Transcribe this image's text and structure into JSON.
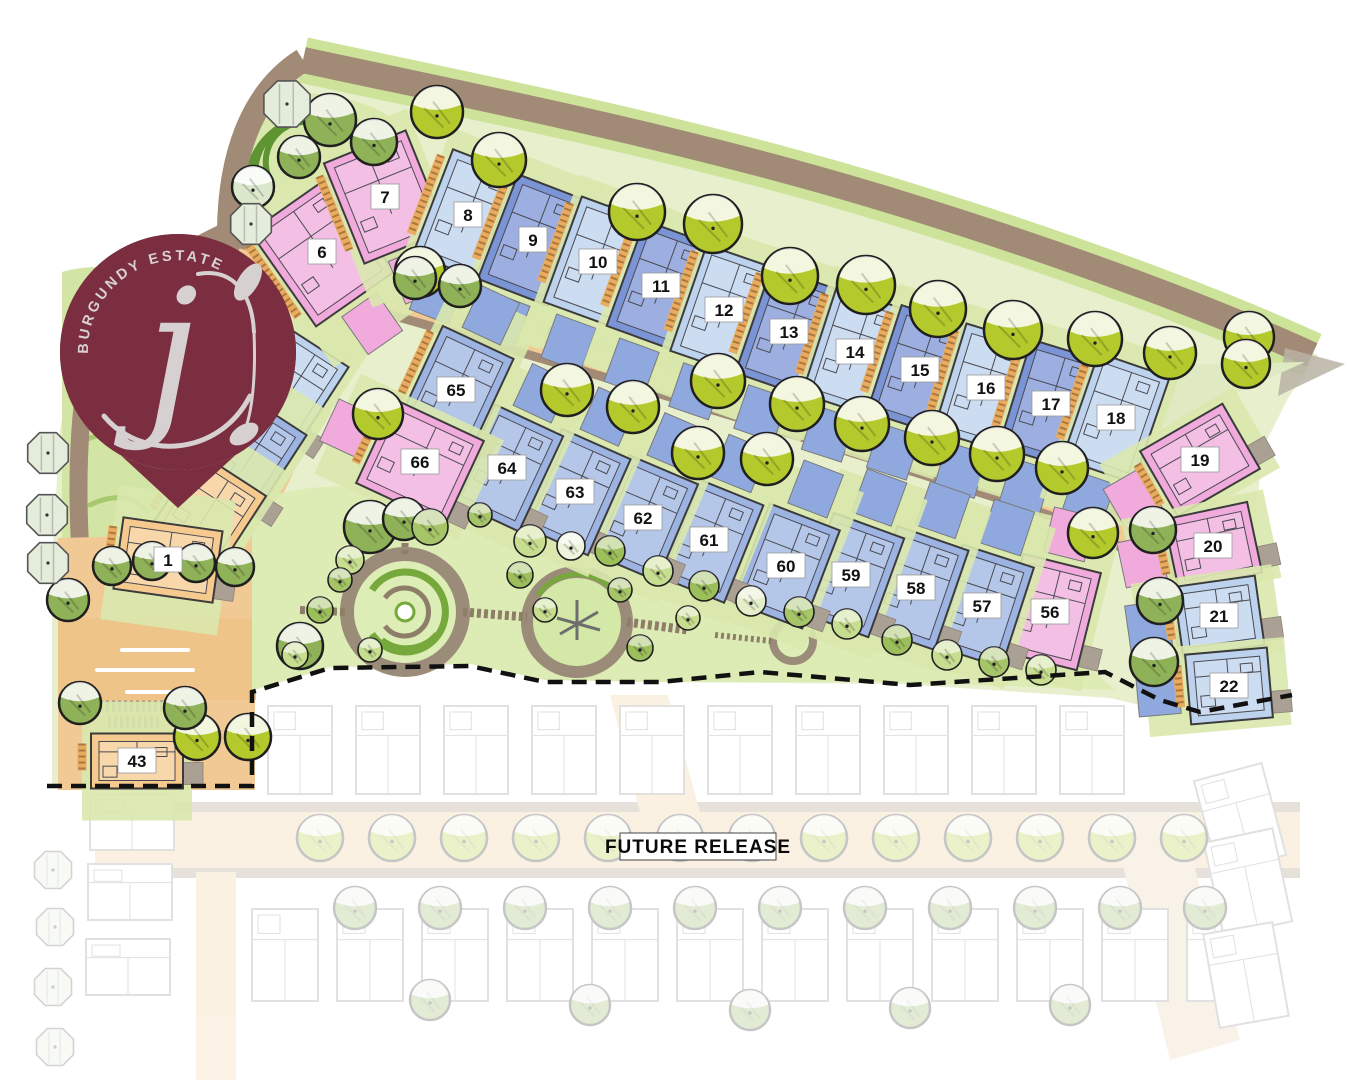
{
  "logo": {
    "estate_name": "BURGUNDY ESTATE",
    "monogram": "j",
    "pin_color": "#7a2e40",
    "text_color": "#d9d2d3"
  },
  "future_release": {
    "label": "FUTURE RELEASE"
  },
  "palette": {
    "dark_blue": "#7b94d6",
    "medium_blue": "#9db4e2",
    "light_blue": "#bdd2ec",
    "pink": "#f0aadb",
    "tan": "#f6ca8e",
    "accent_blue": "#8fa8dd",
    "grass": "#e8efcd",
    "park": "#ddecb4",
    "road_brown": "#a18b76",
    "road_tan": "#f0c994",
    "tree_lime": "#b3c92c",
    "tree_green": "#8fb158"
  },
  "lots": [
    {
      "num": "1",
      "x": 168,
      "y": 560,
      "rot": 8,
      "w": 100,
      "h": 72,
      "color": "tan",
      "acc": ""
    },
    {
      "num": "6",
      "x": 322,
      "y": 252,
      "rot": -35,
      "w": 95,
      "h": 115,
      "color": "pink",
      "acc": "S"
    },
    {
      "num": "7",
      "x": 385,
      "y": 197,
      "rot": -22,
      "w": 88,
      "h": 108,
      "color": "pink",
      "acc": "S"
    },
    {
      "num": "8",
      "x": 468,
      "y": 215,
      "rot": 21,
      "w": 75,
      "h": 112,
      "color": "light",
      "acc": "S"
    },
    {
      "num": "9",
      "x": 533,
      "y": 240,
      "rot": 21,
      "w": 75,
      "h": 112,
      "color": "dark",
      "acc": "S"
    },
    {
      "num": "10",
      "x": 598,
      "y": 262,
      "rot": 20,
      "w": 75,
      "h": 112,
      "color": "light",
      "acc": "S"
    },
    {
      "num": "11",
      "x": 661,
      "y": 286,
      "rot": 20,
      "w": 75,
      "h": 112,
      "color": "dark",
      "acc": "S"
    },
    {
      "num": "12",
      "x": 724,
      "y": 310,
      "rot": 19,
      "w": 75,
      "h": 112,
      "color": "light",
      "acc": "S"
    },
    {
      "num": "13",
      "x": 789,
      "y": 332,
      "rot": 19,
      "w": 75,
      "h": 112,
      "color": "dark",
      "acc": "S"
    },
    {
      "num": "14",
      "x": 855,
      "y": 352,
      "rot": 18,
      "w": 75,
      "h": 112,
      "color": "light",
      "acc": "S"
    },
    {
      "num": "15",
      "x": 920,
      "y": 370,
      "rot": 18,
      "w": 75,
      "h": 112,
      "color": "dark",
      "acc": "S"
    },
    {
      "num": "16",
      "x": 986,
      "y": 388,
      "rot": 17,
      "w": 75,
      "h": 112,
      "color": "light",
      "acc": "S"
    },
    {
      "num": "17",
      "x": 1051,
      "y": 404,
      "rot": 17,
      "w": 75,
      "h": 112,
      "color": "dark",
      "acc": "S"
    },
    {
      "num": "18",
      "x": 1116,
      "y": 418,
      "rot": 19,
      "w": 75,
      "h": 112,
      "color": "light",
      "acc": "S"
    },
    {
      "num": "19",
      "x": 1200,
      "y": 460,
      "rot": -30,
      "w": 95,
      "h": 75,
      "color": "pink",
      "acc": "W"
    },
    {
      "num": "20",
      "x": 1213,
      "y": 546,
      "rot": -12,
      "w": 85,
      "h": 72,
      "color": "pink",
      "acc": "W"
    },
    {
      "num": "21",
      "x": 1219,
      "y": 616,
      "rot": -8,
      "w": 82,
      "h": 70,
      "color": "light",
      "acc": "W"
    },
    {
      "num": "22",
      "x": 1229,
      "y": 686,
      "rot": -5,
      "w": 82,
      "h": 70,
      "color": "light",
      "acc": "W"
    },
    {
      "num": "43",
      "x": 137,
      "y": 761,
      "rot": 0,
      "w": 92,
      "h": 55,
      "color": "tan",
      "acc": ""
    },
    {
      "num": "56",
      "x": 1050,
      "y": 612,
      "rot": 14,
      "w": 80,
      "h": 100,
      "color": "pink",
      "acc": "N"
    },
    {
      "num": "57",
      "x": 982,
      "y": 606,
      "rot": 18,
      "w": 75,
      "h": 105,
      "color": "medium",
      "acc": "N"
    },
    {
      "num": "58",
      "x": 916,
      "y": 588,
      "rot": 19,
      "w": 75,
      "h": 105,
      "color": "medium",
      "acc": "N"
    },
    {
      "num": "59",
      "x": 851,
      "y": 575,
      "rot": 20,
      "w": 75,
      "h": 105,
      "color": "medium",
      "acc": "N"
    },
    {
      "num": "60",
      "x": 786,
      "y": 566,
      "rot": 21,
      "w": 75,
      "h": 105,
      "color": "medium",
      "acc": "N"
    },
    {
      "num": "61",
      "x": 709,
      "y": 540,
      "rot": 22,
      "w": 75,
      "h": 105,
      "color": "medium",
      "acc": "N"
    },
    {
      "num": "62",
      "x": 643,
      "y": 518,
      "rot": 23,
      "w": 75,
      "h": 105,
      "color": "medium",
      "acc": "N"
    },
    {
      "num": "63",
      "x": 575,
      "y": 492,
      "rot": 24,
      "w": 75,
      "h": 105,
      "color": "medium",
      "acc": "N"
    },
    {
      "num": "64",
      "x": 507,
      "y": 468,
      "rot": 25,
      "w": 75,
      "h": 105,
      "color": "medium",
      "acc": "N"
    },
    {
      "num": "65",
      "x": 456,
      "y": 390,
      "rot": 25,
      "w": 78,
      "h": 105,
      "color": "medium",
      "acc": "N"
    },
    {
      "num": "66",
      "x": 420,
      "y": 462,
      "rot": 25,
      "w": 98,
      "h": 92,
      "color": "pink",
      "acc": "W"
    }
  ],
  "partial_lots": [
    {
      "x": 292,
      "y": 390,
      "rot": 33,
      "w": 70,
      "h": 100,
      "color": "light"
    },
    {
      "x": 250,
      "y": 458,
      "rot": 33,
      "w": 70,
      "h": 100,
      "color": "medium"
    },
    {
      "x": 208,
      "y": 512,
      "rot": 33,
      "w": 80,
      "h": 90,
      "color": "tan"
    }
  ],
  "trees": [
    {
      "t": "lime",
      "x": 437,
      "y": 112,
      "r": 26
    },
    {
      "t": "lime",
      "x": 499,
      "y": 160,
      "r": 27
    },
    {
      "t": "lime",
      "x": 637,
      "y": 212,
      "r": 28
    },
    {
      "t": "lime",
      "x": 713,
      "y": 224,
      "r": 29
    },
    {
      "t": "lime",
      "x": 790,
      "y": 276,
      "r": 28
    },
    {
      "t": "lime",
      "x": 866,
      "y": 285,
      "r": 29
    },
    {
      "t": "lime",
      "x": 938,
      "y": 309,
      "r": 28
    },
    {
      "t": "lime",
      "x": 1013,
      "y": 330,
      "r": 29
    },
    {
      "t": "lime",
      "x": 1095,
      "y": 339,
      "r": 27
    },
    {
      "t": "lime",
      "x": 1170,
      "y": 353,
      "r": 26
    },
    {
      "t": "lime",
      "x": 1249,
      "y": 337,
      "r": 25
    },
    {
      "t": "lime",
      "x": 1246,
      "y": 364,
      "r": 24
    },
    {
      "t": "lime",
      "x": 420,
      "y": 272,
      "r": 25
    },
    {
      "t": "lime",
      "x": 567,
      "y": 390,
      "r": 26
    },
    {
      "t": "lime",
      "x": 633,
      "y": 407,
      "r": 26
    },
    {
      "t": "lime",
      "x": 718,
      "y": 381,
      "r": 27
    },
    {
      "t": "lime",
      "x": 797,
      "y": 404,
      "r": 27
    },
    {
      "t": "lime",
      "x": 862,
      "y": 424,
      "r": 27
    },
    {
      "t": "lime",
      "x": 932,
      "y": 438,
      "r": 27
    },
    {
      "t": "lime",
      "x": 997,
      "y": 454,
      "r": 27
    },
    {
      "t": "lime",
      "x": 1062,
      "y": 468,
      "r": 26
    },
    {
      "t": "lime",
      "x": 1093,
      "y": 533,
      "r": 25
    },
    {
      "t": "lime",
      "x": 378,
      "y": 414,
      "r": 25
    },
    {
      "t": "lime",
      "x": 698,
      "y": 453,
      "r": 26
    },
    {
      "t": "lime",
      "x": 767,
      "y": 459,
      "r": 26
    },
    {
      "t": "lime",
      "x": 197,
      "y": 737,
      "r": 23
    },
    {
      "t": "lime",
      "x": 248,
      "y": 737,
      "r": 23
    },
    {
      "t": "green",
      "x": 415,
      "y": 278,
      "r": 21
    },
    {
      "t": "green",
      "x": 460,
      "y": 286,
      "r": 21
    },
    {
      "t": "green",
      "x": 330,
      "y": 120,
      "r": 26
    },
    {
      "t": "green",
      "x": 374,
      "y": 142,
      "r": 23
    },
    {
      "t": "green",
      "x": 299,
      "y": 157,
      "r": 21
    },
    {
      "t": "green",
      "x": 68,
      "y": 600,
      "r": 21
    },
    {
      "t": "green",
      "x": 112,
      "y": 566,
      "r": 19
    },
    {
      "t": "green",
      "x": 152,
      "y": 561,
      "r": 19
    },
    {
      "t": "green",
      "x": 196,
      "y": 563,
      "r": 19
    },
    {
      "t": "green",
      "x": 235,
      "y": 567,
      "r": 19
    },
    {
      "t": "green",
      "x": 300,
      "y": 646,
      "r": 23
    },
    {
      "t": "green",
      "x": 80,
      "y": 703,
      "r": 21
    },
    {
      "t": "green",
      "x": 185,
      "y": 708,
      "r": 21
    },
    {
      "t": "green",
      "x": 1153,
      "y": 530,
      "r": 23
    },
    {
      "t": "green",
      "x": 1160,
      "y": 601,
      "r": 23
    },
    {
      "t": "green",
      "x": 1154,
      "y": 662,
      "r": 24
    },
    {
      "t": "green",
      "x": 370,
      "y": 527,
      "r": 26
    },
    {
      "t": "green",
      "x": 404,
      "y": 519,
      "r": 21
    },
    {
      "t": "pale",
      "x": 253,
      "y": 187,
      "r": 21
    },
    {
      "t": "oct",
      "x": 287,
      "y": 104,
      "r": 25
    },
    {
      "t": "oct",
      "x": 251,
      "y": 224,
      "r": 22
    },
    {
      "t": "oct",
      "x": 48,
      "y": 453,
      "r": 22
    },
    {
      "t": "oct",
      "x": 47,
      "y": 515,
      "r": 22
    },
    {
      "t": "oct",
      "x": 48,
      "y": 563,
      "r": 22
    },
    {
      "t": "shrub",
      "x": 430,
      "y": 527,
      "r": 18,
      "c": "#a6c468"
    },
    {
      "t": "shrub",
      "x": 530,
      "y": 541,
      "r": 16,
      "c": "#c7dd8f"
    },
    {
      "t": "shrub",
      "x": 571,
      "y": 546,
      "r": 14,
      "c": "#eef4dd"
    },
    {
      "t": "shrub",
      "x": 610,
      "y": 551,
      "r": 15,
      "c": "#9cbf5c"
    },
    {
      "t": "shrub",
      "x": 658,
      "y": 571,
      "r": 15,
      "c": "#c7dd8f"
    },
    {
      "t": "shrub",
      "x": 704,
      "y": 586,
      "r": 15,
      "c": "#9cbf5c"
    },
    {
      "t": "shrub",
      "x": 751,
      "y": 601,
      "r": 15,
      "c": "#e4eecb"
    },
    {
      "t": "shrub",
      "x": 799,
      "y": 612,
      "r": 15,
      "c": "#a6c468"
    },
    {
      "t": "shrub",
      "x": 847,
      "y": 624,
      "r": 15,
      "c": "#c7dd8f"
    },
    {
      "t": "shrub",
      "x": 897,
      "y": 640,
      "r": 15,
      "c": "#9cbf5c"
    },
    {
      "t": "shrub",
      "x": 947,
      "y": 655,
      "r": 15,
      "c": "#c7dd8f"
    },
    {
      "t": "shrub",
      "x": 994,
      "y": 662,
      "r": 15,
      "c": "#a6c468"
    },
    {
      "t": "shrub",
      "x": 1041,
      "y": 670,
      "r": 15,
      "c": "#c7dd8f"
    },
    {
      "t": "shrub",
      "x": 520,
      "y": 575,
      "r": 13,
      "c": "#9cbf5c"
    },
    {
      "t": "shrub",
      "x": 545,
      "y": 610,
      "r": 12,
      "c": "#c7dd8f"
    },
    {
      "t": "shrub",
      "x": 620,
      "y": 590,
      "r": 12,
      "c": "#a6c468"
    },
    {
      "t": "shrub",
      "x": 640,
      "y": 648,
      "r": 13,
      "c": "#9cbf5c"
    },
    {
      "t": "shrub",
      "x": 688,
      "y": 618,
      "r": 12,
      "c": "#c7dd8f"
    },
    {
      "t": "shrub",
      "x": 480,
      "y": 515,
      "r": 12,
      "c": "#a6c468"
    },
    {
      "t": "shrub",
      "x": 350,
      "y": 560,
      "r": 14,
      "c": "#c7dd8f"
    },
    {
      "t": "shrub",
      "x": 320,
      "y": 610,
      "r": 13,
      "c": "#9cbf5c"
    },
    {
      "t": "shrub",
      "x": 295,
      "y": 655,
      "r": 13,
      "c": "#c7dd8f"
    },
    {
      "t": "shrub",
      "x": 340,
      "y": 580,
      "r": 12,
      "c": "#a6c468"
    },
    {
      "t": "shrub",
      "x": 370,
      "y": 650,
      "r": 12,
      "c": "#c7dd8f"
    }
  ]
}
